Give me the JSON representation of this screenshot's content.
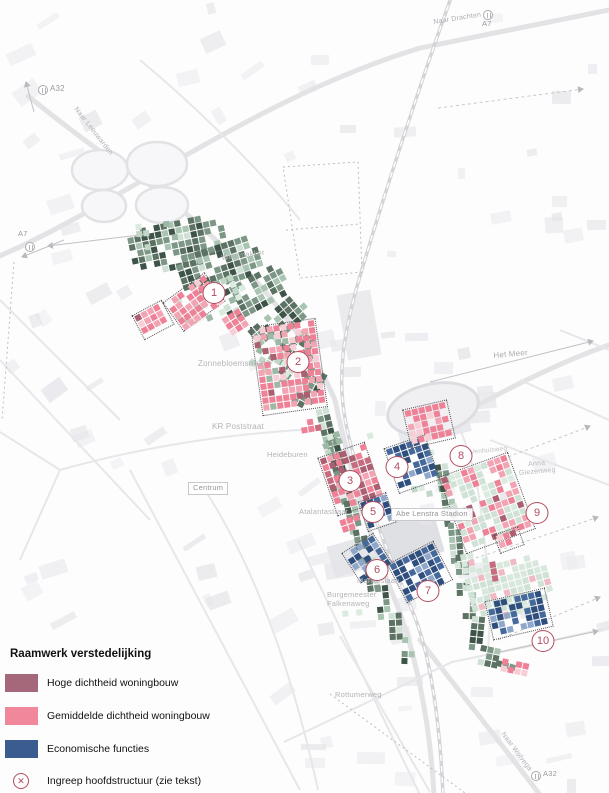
{
  "legend": {
    "title": "Raamwerk verstedelijking",
    "items": [
      {
        "label": "Hoge dichtheid woningbouw",
        "color": "#a5687b",
        "symbol": "swatch"
      },
      {
        "label": "Gemiddelde dichtheid woningbouw",
        "color": "#f0879b",
        "symbol": "swatch"
      },
      {
        "label": "Economische functies",
        "color": "#3a5c8e",
        "symbol": "swatch"
      },
      {
        "label": "Ingreep hoofdstructuur (zie tekst)",
        "color": "#b34b5e",
        "symbol": "circle-x",
        "glyph": "✕"
      }
    ]
  },
  "markers": [
    {
      "label": "1"
    },
    {
      "label": "2"
    },
    {
      "label": "3"
    },
    {
      "label": "4"
    },
    {
      "label": "5"
    },
    {
      "label": "6"
    },
    {
      "label": "7"
    },
    {
      "label": "8"
    },
    {
      "label": "9"
    },
    {
      "label": "10"
    }
  ],
  "map_labels": [
    {
      "text": "A32"
    },
    {
      "text": "Naar Leeuwarden"
    },
    {
      "text": "Naar Drachten"
    },
    {
      "text": "A7"
    },
    {
      "text": "A7"
    },
    {
      "text": "Weinmakker"
    },
    {
      "text": "Zonnebloemstraat"
    },
    {
      "text": "KR Poststraat"
    },
    {
      "text": "Heideburen"
    },
    {
      "text": "Centrum"
    },
    {
      "text": "Atalantastraat"
    },
    {
      "text": "Abe Lenstra Stadion"
    },
    {
      "text": "Het Meer"
    },
    {
      "text": "Venhuisweg"
    },
    {
      "text": "Anna\nGiezenweg"
    },
    {
      "text": "Mankeslaan"
    },
    {
      "text": "Burgemeester\nFalkenaweg"
    },
    {
      "text": "Rottumerweg"
    },
    {
      "text": "Naar Wolvega"
    },
    {
      "text": "A32"
    }
  ],
  "colors": {
    "high_density": "#ad5f72",
    "medium_density": "#ee8196",
    "economic": "#2e4e7e",
    "green_dark": "#5c7263",
    "green_light": "#c2d7c8",
    "marker_accent": "#b34b5e"
  }
}
